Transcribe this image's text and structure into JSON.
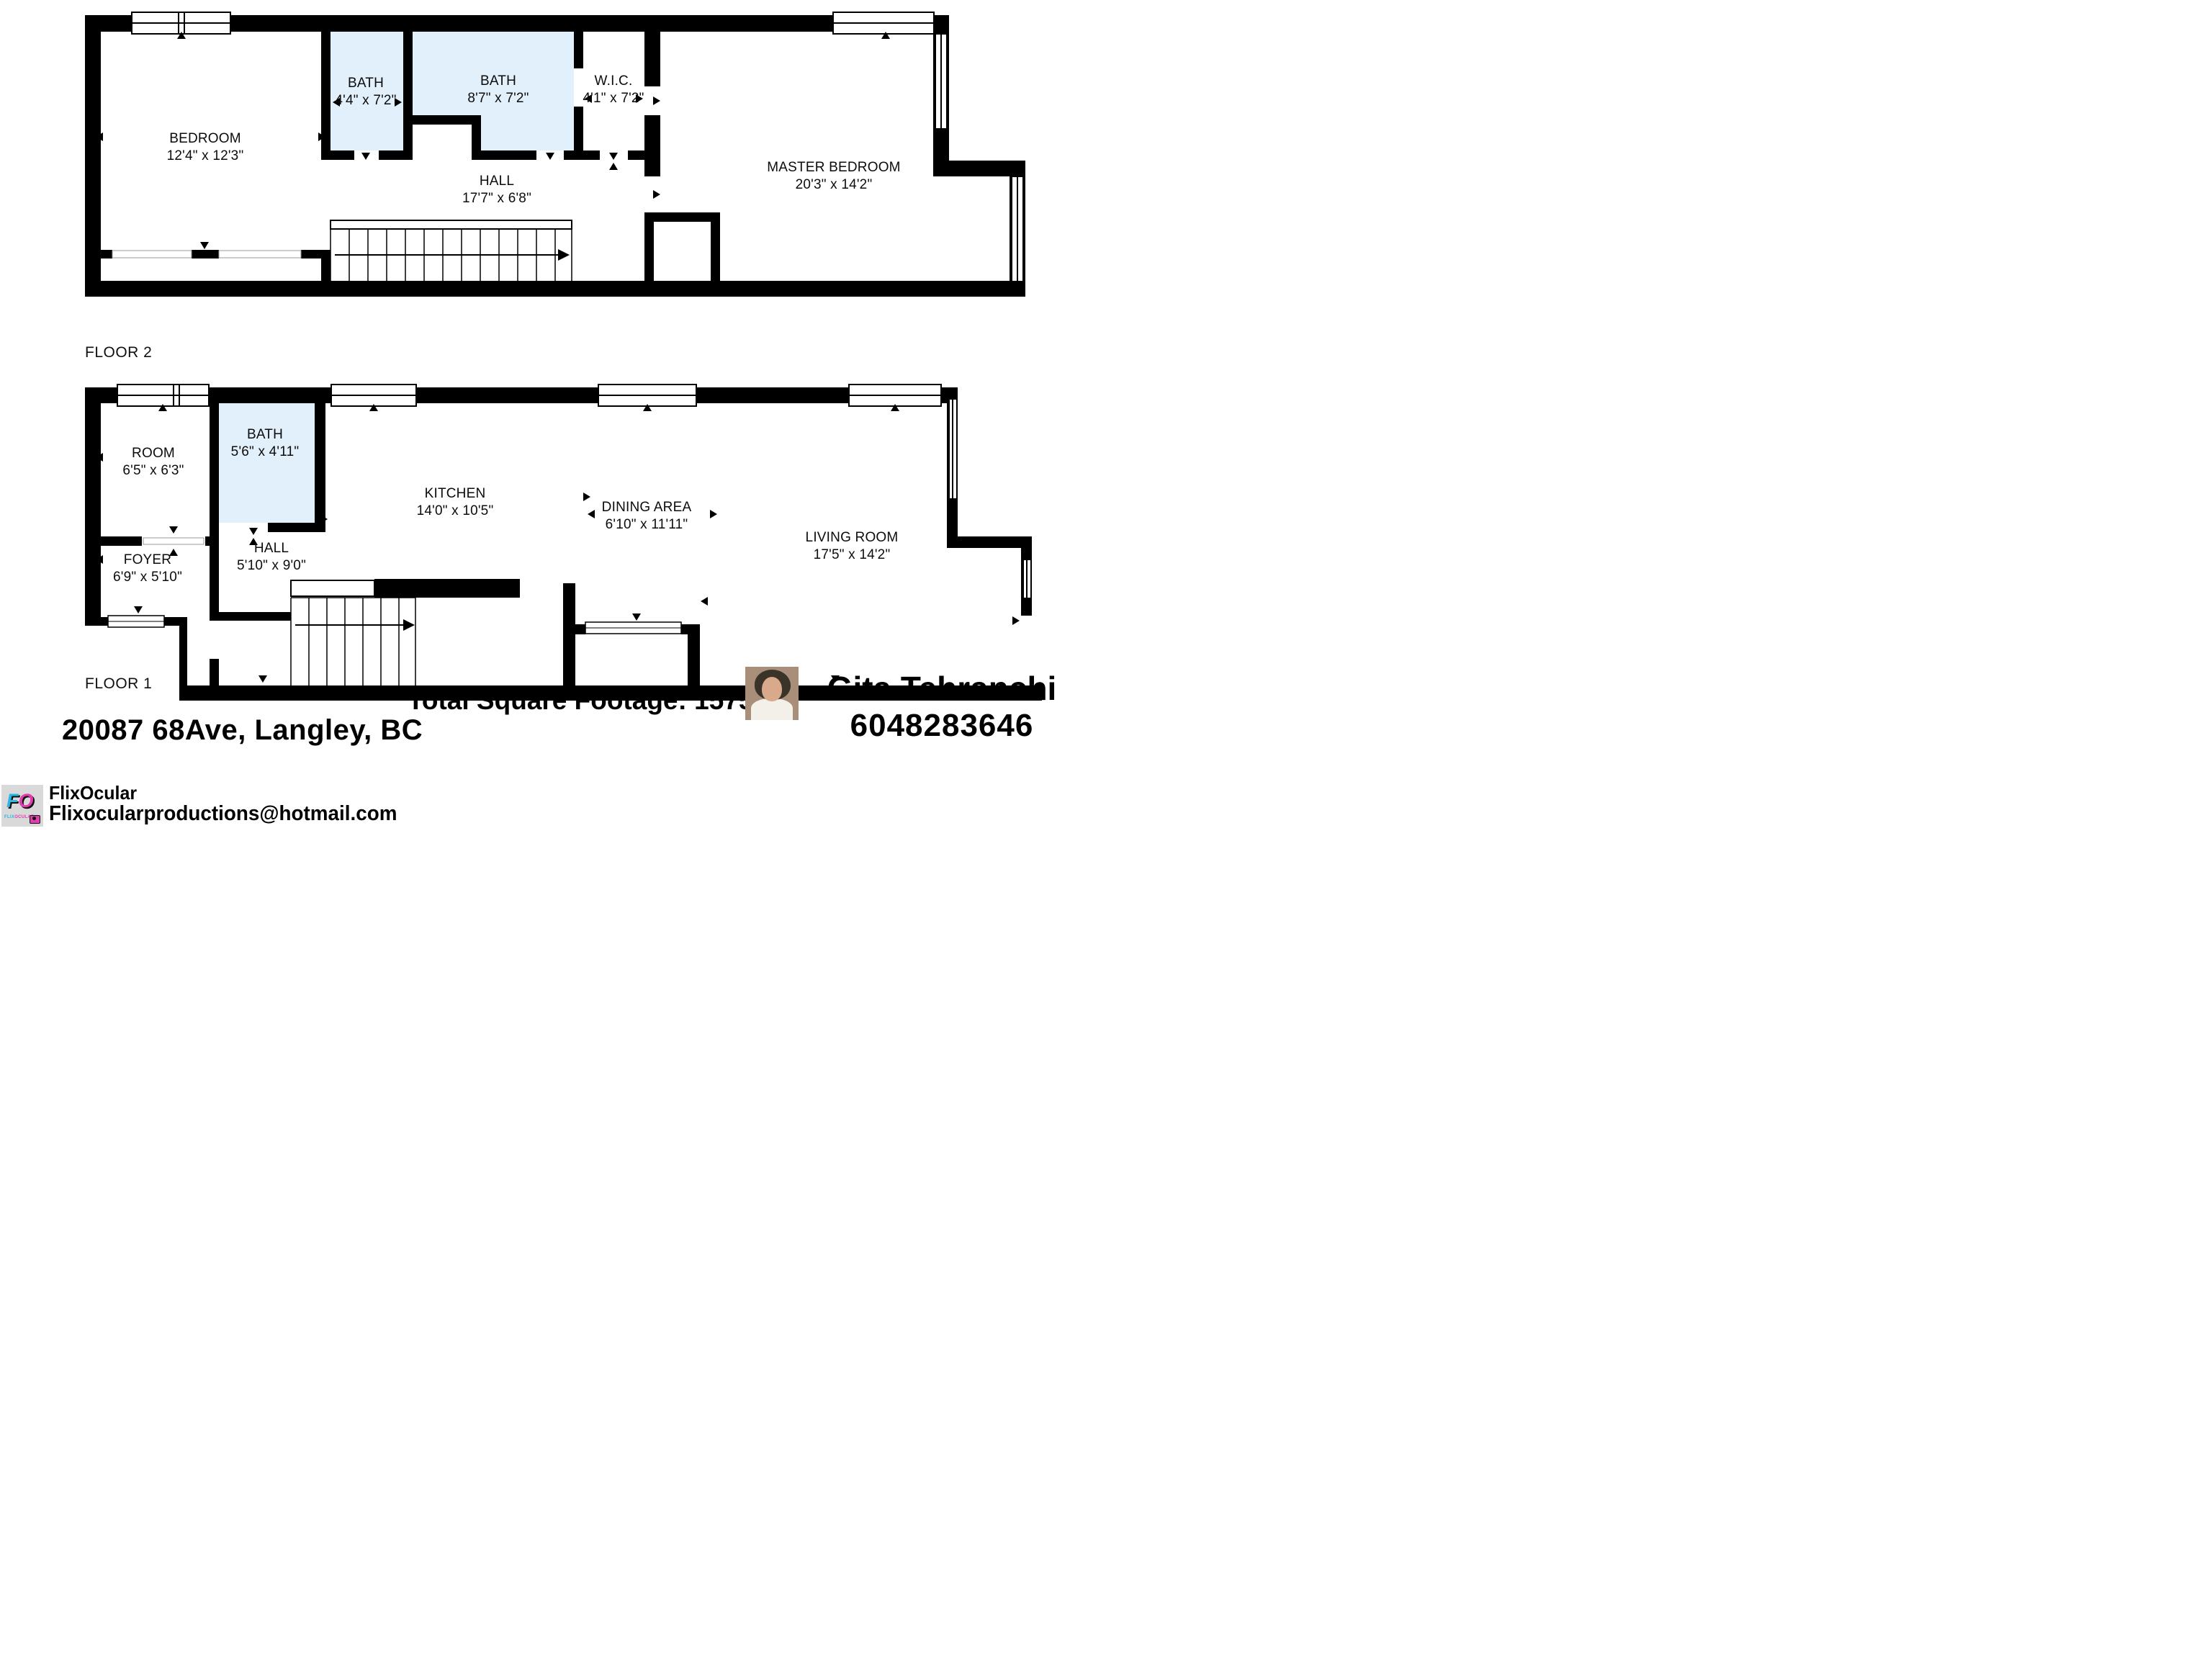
{
  "colors": {
    "bath_fill": "#e2f0fb",
    "wall": "#000000",
    "logo_gray": "#d9d9d9",
    "logo_blue": "#2ab5e6",
    "logo_pink": "#e23bb0"
  },
  "floor2": {
    "label": "FLOOR 2",
    "rooms": [
      {
        "name": "BEDROOM",
        "dims": "12'4\" x 12'3\""
      },
      {
        "name": "BATH",
        "dims": "4'4\" x 7'2\""
      },
      {
        "name": "BATH",
        "dims": "8'7\" x 7'2\""
      },
      {
        "name": "W.I.C.",
        "dims": "4'1\" x 7'2\""
      },
      {
        "name": "HALL",
        "dims": "17'7\" x 6'8\""
      },
      {
        "name": "MASTER BEDROOM",
        "dims": "20'3\" x 14'2\""
      }
    ]
  },
  "floor1": {
    "label": "FLOOR 1",
    "rooms": [
      {
        "name": "ROOM",
        "dims": "6'5\" x 6'3\""
      },
      {
        "name": "BATH",
        "dims": "5'6\" x 4'11\""
      },
      {
        "name": "KITCHEN",
        "dims": "14'0\" x 10'5\""
      },
      {
        "name": "DINING AREA",
        "dims": "6'10\" x 11'11\""
      },
      {
        "name": "LIVING ROOM",
        "dims": "17'5\" x 14'2\""
      },
      {
        "name": "FOYER",
        "dims": "6'9\" x 5'10\""
      },
      {
        "name": "HALL",
        "dims": "5'10\" x 9'0\""
      }
    ]
  },
  "footer": {
    "address": "20087 68Ave, Langley, BC",
    "total": "Total Square Footage: 1575",
    "agent_name": "Gita Tehranchi",
    "agent_phone": "6048283646",
    "brand": "FlixOcular",
    "email": "Flixocularproductions@hotmail.com",
    "logo_f": "F",
    "logo_o": "O",
    "logo_sub1": "FLIX",
    "logo_sub2": "OCULAR"
  }
}
